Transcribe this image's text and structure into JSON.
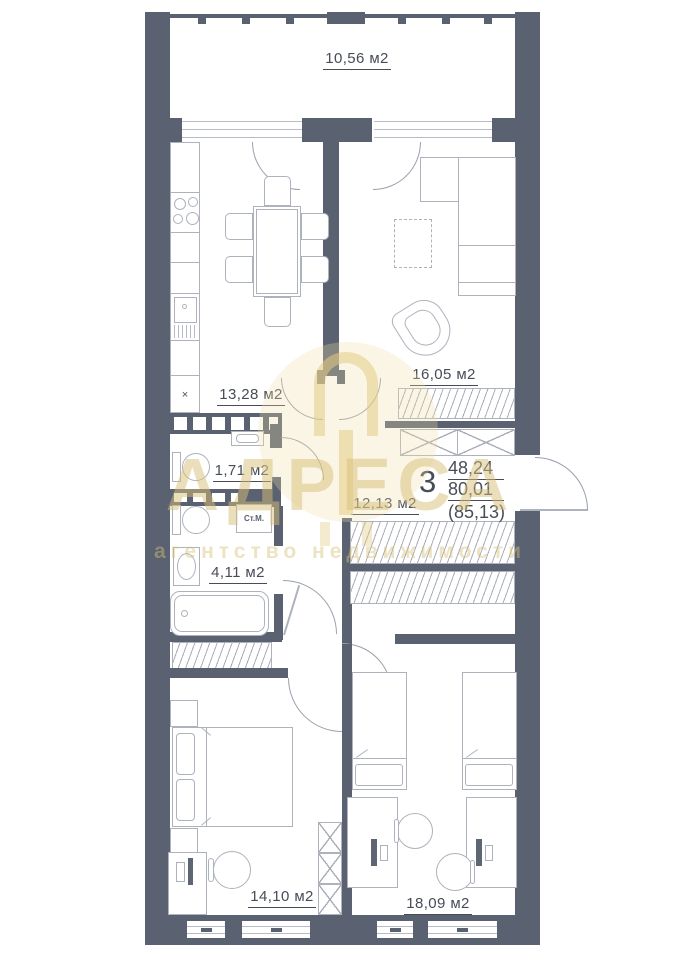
{
  "document": {
    "kind": "apartment floor plan"
  },
  "watermark": {
    "brand": "АДРЕСА",
    "subtitle": "агентство недвижимости"
  },
  "summary": {
    "rooms_count": "3",
    "value1": "48,24",
    "value2": "80,01",
    "value3": "(85,13)"
  },
  "rooms": {
    "balcony": {
      "label": "10,56 м2"
    },
    "kitchen": {
      "label": "13,28 м2"
    },
    "living": {
      "label": "16,05 м2"
    },
    "toilet": {
      "label": "1,71 м2"
    },
    "hallway": {
      "label": "12,13 м2"
    },
    "bathroom": {
      "label": "4,11 м2"
    },
    "bedroom1": {
      "label": "14,10 м2"
    },
    "bedroom2": {
      "label": "18,09 м2"
    }
  },
  "fixtures": {
    "washing_machine": "Ст.М.",
    "fridge_mark": "×"
  },
  "colors": {
    "wall": "#5a6170",
    "furniture_line": "#adb2bc",
    "text": "#474c57",
    "watermark_gold": "#d8c078"
  }
}
